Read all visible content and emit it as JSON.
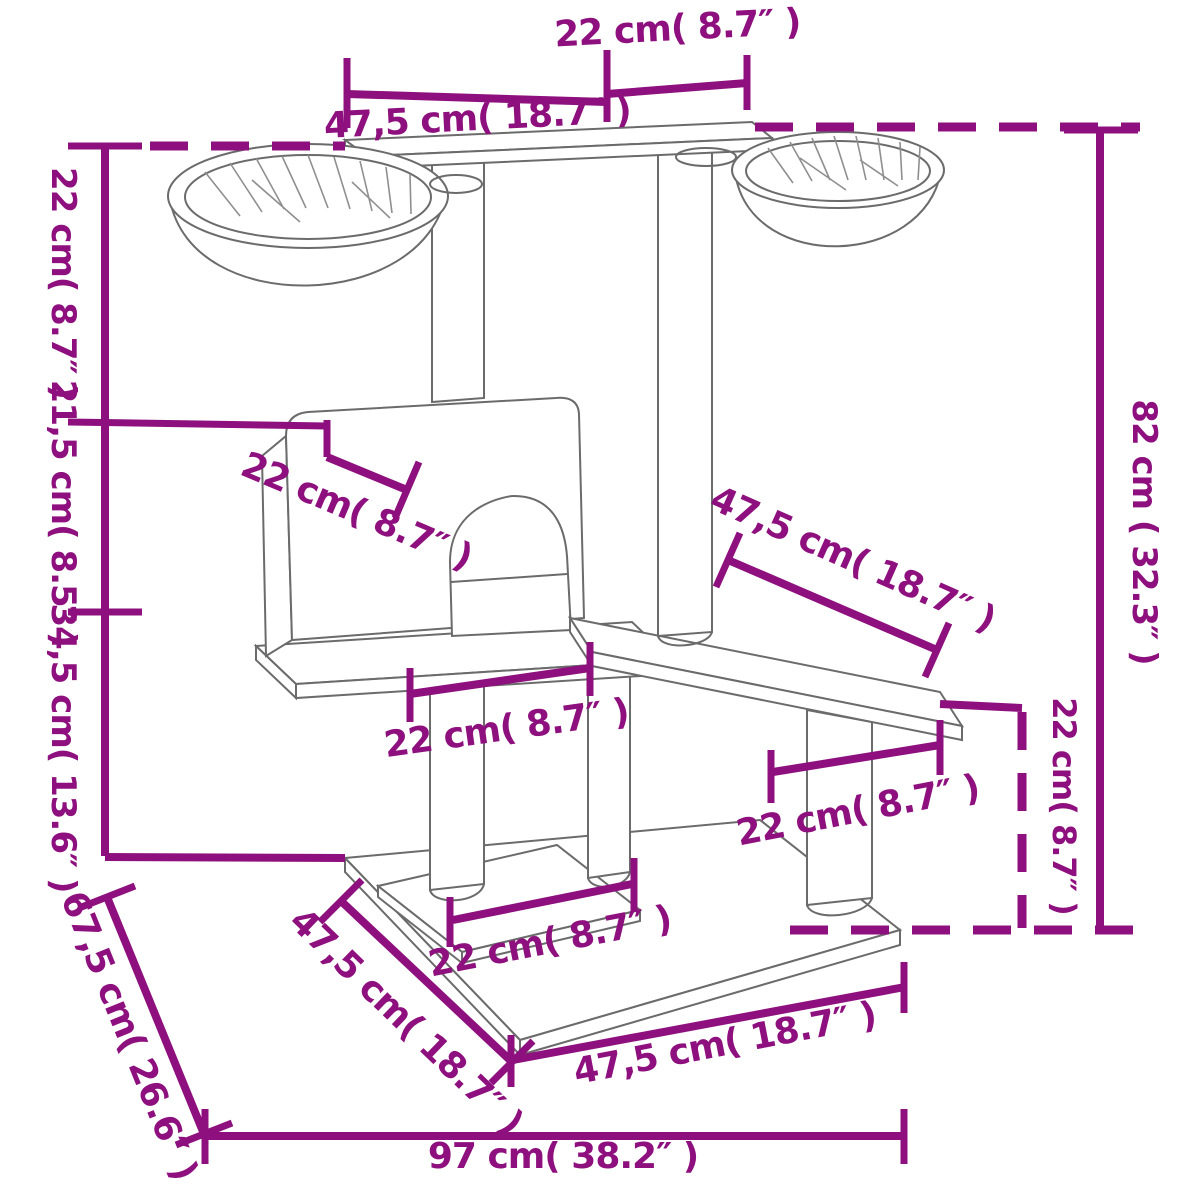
{
  "diagram": {
    "accent_color": "#8e107e",
    "line_color": "#6b6b6b",
    "background_color": "#ffffff",
    "dimensions": {
      "top_depth": "22 cm( 8.7″ )",
      "top_width": "47,5 cm( 18.7″ )",
      "upper_height": "22 cm( 8.7″ )",
      "mid_height": "21,5 cm( 8.5″ )",
      "lower_height": "34,5 cm( 13.6″ )",
      "total_height": "82 cm ( 32.3″ )",
      "house_depth": "22 cm( 8.7″ )",
      "mid_platform_width": "47,5 cm( 18.7″ )",
      "house_board_width": "22 cm( 8.7″ )",
      "step_platform_width": "22 cm( 8.7″ )",
      "step_height": "22 cm( 8.7″ )",
      "base_step_width": "22 cm( 8.7″ )",
      "base_side_depth": "47,5 cm( 18.7″ )",
      "base_diagonal": "67,5 cm( 26.6″ )",
      "base_front_width": "47,5 cm( 18.7″ )",
      "base_total_width": "97 cm( 38.2″ )"
    }
  }
}
